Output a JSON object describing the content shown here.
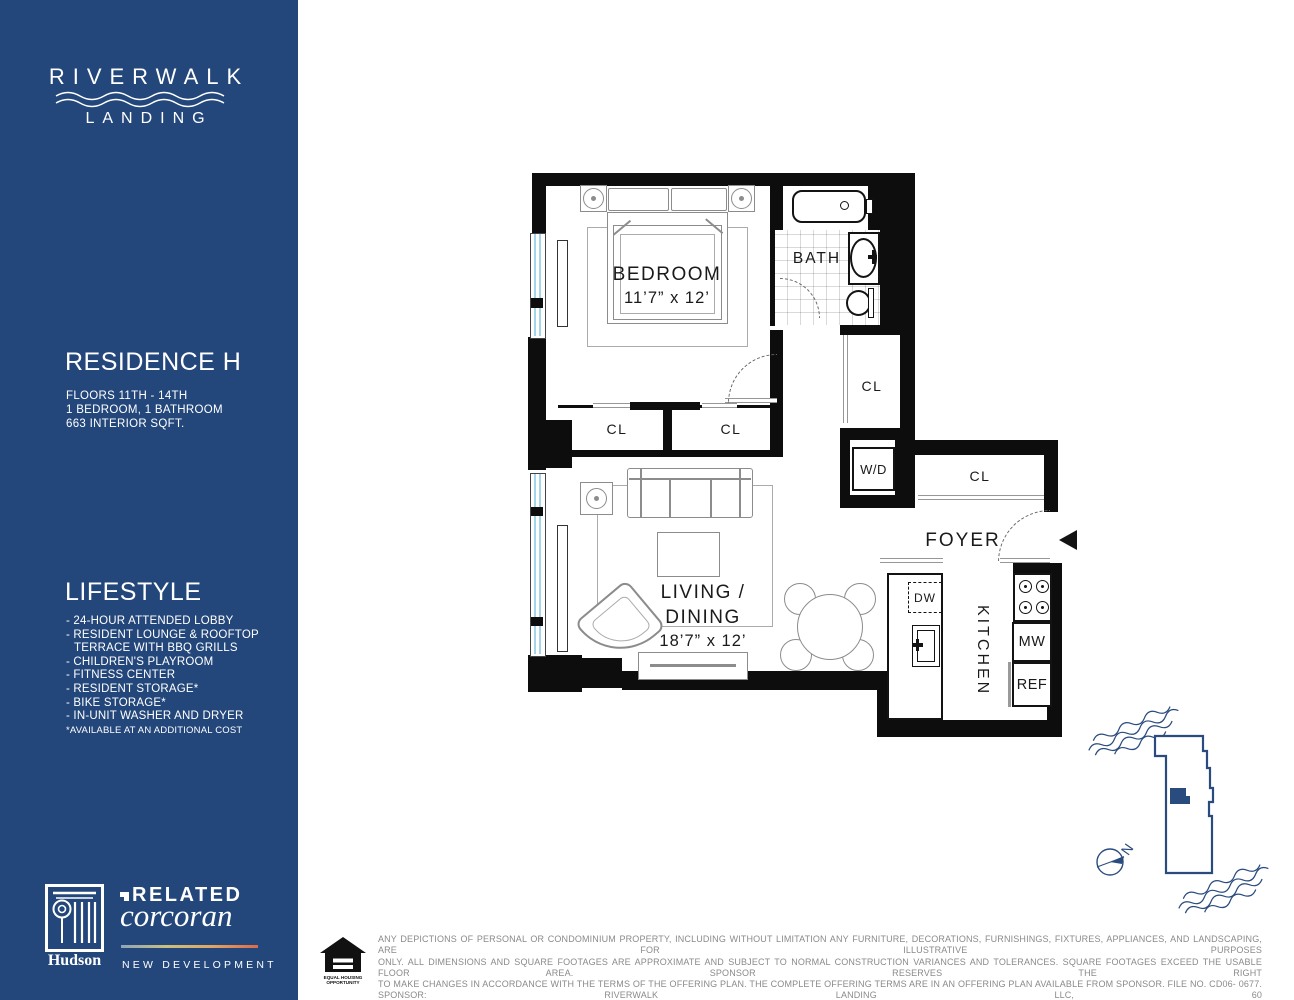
{
  "colors": {
    "navy": "#24477B",
    "plan_wall_black": "#0d0d0d",
    "window_glass_blue": "#A5D5E8",
    "furniture_gray": "#8C8C8C",
    "disclaimer_gray": "#8a8a8a",
    "corcoran_gradient": [
      "#8fa5ba",
      "#c9c07e",
      "#e0a565",
      "#db6a4d"
    ]
  },
  "sidebar": {
    "brand_line1": "RIVERWALK",
    "brand_line2": "LANDING",
    "residence_title": "RESIDENCE H",
    "residence_details": [
      "FLOORS 11TH - 14TH",
      "1 BEDROOM, 1 BATHROOM",
      "663 INTERIOR SQFT."
    ],
    "lifestyle_title": "LIFESTYLE",
    "lifestyle_items": [
      "- 24-HOUR ATTENDED LOBBY",
      "- RESIDENT LOUNGE & ROOFTOP TERRACE WITH BBQ GRILLS",
      "- CHILDREN'S PLAYROOM",
      "- FITNESS CENTER",
      "- RESIDENT STORAGE*",
      "- BIKE STORAGE*",
      "- IN-UNIT WASHER AND DRYER"
    ],
    "lifestyle_footnote": "*AVAILABLE AT AN ADDITIONAL COST",
    "hudson_label": "Hudson",
    "related_label": "RELATED",
    "corcoran_label": "corcoran",
    "new_development_label": "NEW DEVELOPMENT"
  },
  "plan": {
    "bedroom_name": "BEDROOM",
    "bedroom_dims": "11’7” x 12’",
    "bath_label": "BATH",
    "cl_label": "CL",
    "wd_label": "W/D",
    "foyer_label": "FOYER",
    "living_name_line1": "LIVING /",
    "living_name_line2": "DINING",
    "living_dims": "18’7” x 12’",
    "kitchen_label": "KITCHEN",
    "dw_label": "DW",
    "mw_label": "MW",
    "ref_label": "REF",
    "compass_label": "N"
  },
  "footer": {
    "eho_caption": "EQUAL HOUSING\nOPPORTUNITY",
    "disclaimer_lines": [
      "ANY DEPICTIONS OF PERSONAL OR CONDOMINIUM PROPERTY, INCLUDING WITHOUT LIMITATION ANY FURNITURE, DECORATIONS, FURNISHINGS, FIXTURES, APPLIANCES, AND LANDSCAPING, ARE FOR ILLUSTRATIVE PURPOSES",
      "ONLY. ALL DIMENSIONS AND SQUARE FOOTAGES ARE APPROXIMATE AND SUBJECT TO NORMAL CONSTRUCTION VARIANCES AND TOLERANCES. SQUARE FOOTAGES EXCEED THE USABLE FLOOR AREA. SPONSOR RESERVES THE RIGHT",
      "TO MAKE CHANGES IN ACCORDANCE WITH THE TERMS OF THE OFFERING PLAN. THE COMPLETE OFFERING TERMS ARE IN AN OFFERING PLAN AVAILABLE FROM SPONSOR. FILE NO. CD06- 0677. SPONSOR: RIVERWALK LANDING LLC, 60",
      "COLUMBUS CIRCLE, NEW YORK, NEW YORK 10023. EQUAL HOUSING OPPORTUNITY"
    ]
  }
}
